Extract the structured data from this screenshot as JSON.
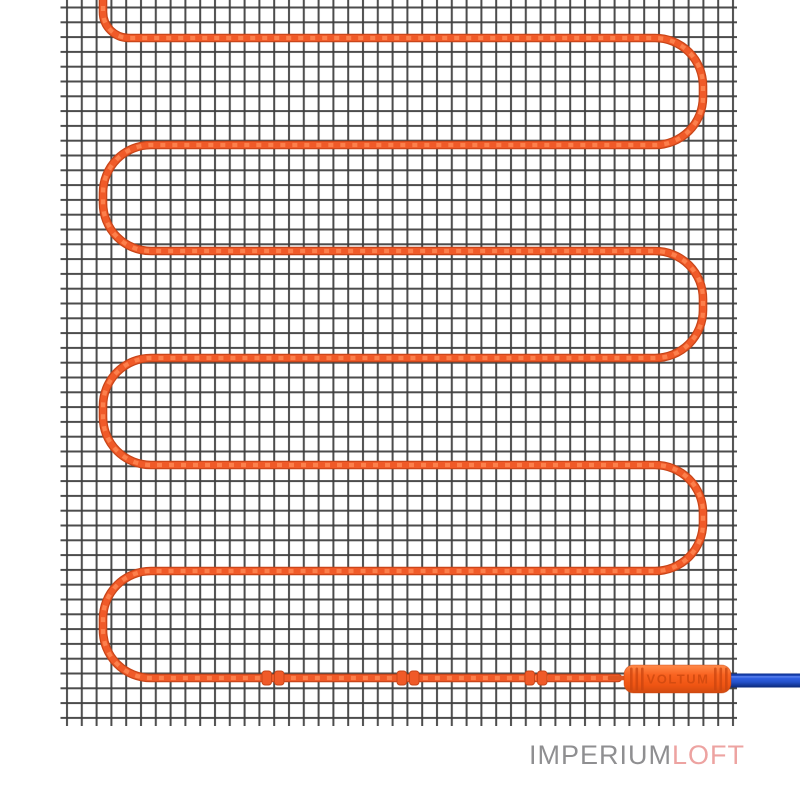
{
  "image": {
    "alt": "Electric underfloor heating mat: orange heating cable laid in a serpentine on a dark mesh grid, held by three small clips, ending in an orange branded coupling joined to a blue power cord"
  },
  "figure": {
    "cable_runs": 7,
    "fastening_clips": 3
  },
  "connector": {
    "brand_label": "VOLTUM"
  },
  "watermark": {
    "brand_primary": "IMPERIUM",
    "brand_accent": "LOFT"
  },
  "colors": {
    "background": "#ffffff",
    "mesh_line": "#3e3e3e",
    "cable_core": "#f05a28",
    "cable_edge": "#c64418",
    "cable_highlight": "#ff8a55",
    "connector_label": "#d0490f",
    "cord_blue": "#2d5ce4",
    "cord_blue_dark": "#0b2c88",
    "watermark_gray": "#8f8f91",
    "watermark_accent": "#eda3a1"
  }
}
